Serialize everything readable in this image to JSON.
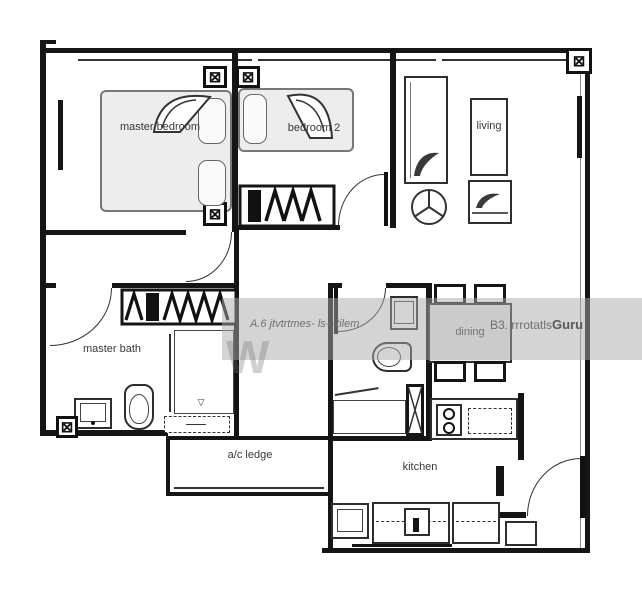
{
  "rooms": {
    "master_bedroom": {
      "label": "master bedroom"
    },
    "bedroom2": {
      "label": "bedroom 2"
    },
    "living": {
      "label": "living"
    },
    "dining": {
      "label": "dining"
    },
    "master_bath": {
      "label": "master bath"
    },
    "kitchen": {
      "label": "kitchen"
    },
    "ac_ledge": {
      "label": "a/c ledge"
    }
  },
  "watermark": {
    "left_text": "A.6 jtvtrtmes- ls- -tilem",
    "right_text": "B3. rrrotatls",
    "brand": "Guru",
    "big_letter": "W"
  },
  "icons": {
    "window_grille": "⊠",
    "corner_column": "⊠",
    "shower_drain": "▽"
  },
  "colors": {
    "wall_ink": "#151515",
    "watermark_band": "#aaaaaa"
  }
}
